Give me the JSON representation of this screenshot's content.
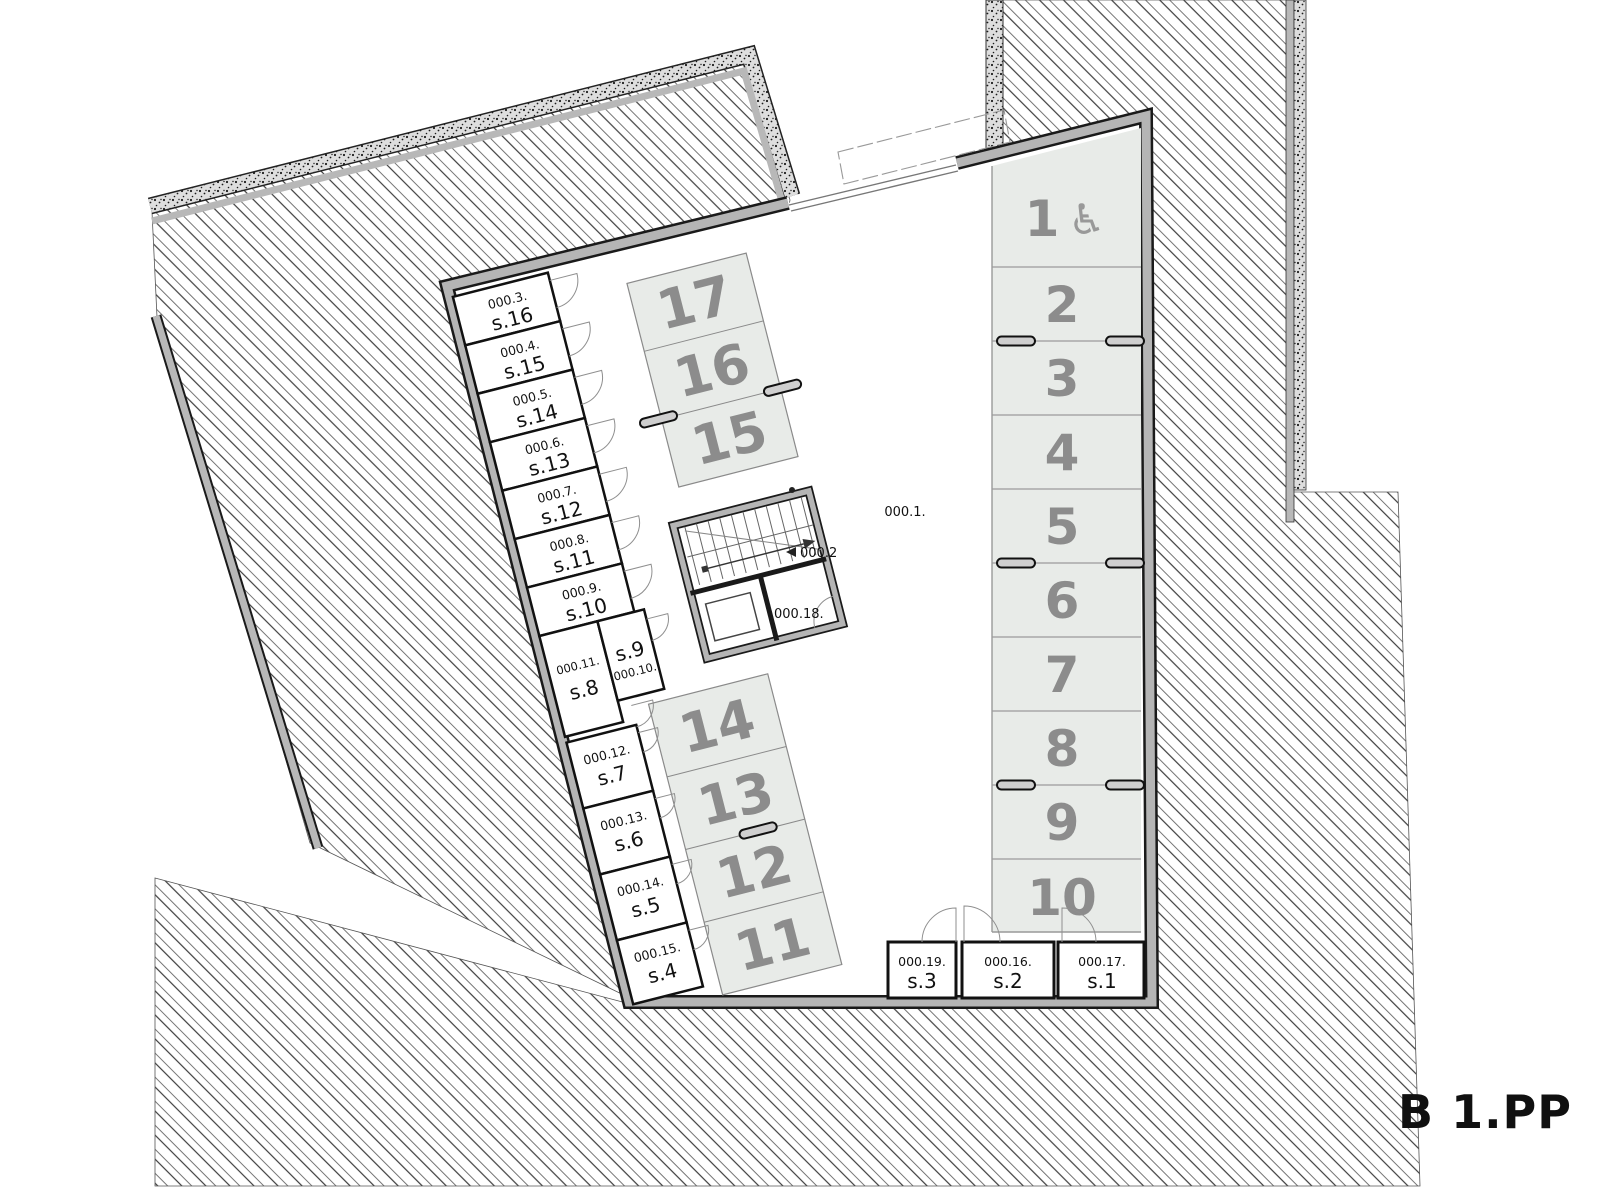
{
  "plan": {
    "title": "B 1.PP"
  },
  "areas": {
    "garage_code": "000.1.",
    "stairs_code": "000.2",
    "utility_code": "000.18."
  },
  "storage_rooms": [
    {
      "code": "000.3.",
      "name": "s.16"
    },
    {
      "code": "000.4.",
      "name": "s.15"
    },
    {
      "code": "000.5.",
      "name": "s.14"
    },
    {
      "code": "000.6.",
      "name": "s.13"
    },
    {
      "code": "000.7.",
      "name": "s.12"
    },
    {
      "code": "000.8.",
      "name": "s.11"
    },
    {
      "code": "000.9.",
      "name": "s.10"
    },
    {
      "code": "000.10.",
      "name": "s.9"
    },
    {
      "code": "000.11.",
      "name": "s.8"
    },
    {
      "code": "000.12.",
      "name": "s.7"
    },
    {
      "code": "000.13.",
      "name": "s.6"
    },
    {
      "code": "000.14.",
      "name": "s.5"
    },
    {
      "code": "000.15.",
      "name": "s.4"
    },
    {
      "code": "000.19.",
      "name": "s.3"
    },
    {
      "code": "000.16.",
      "name": "s.2"
    },
    {
      "code": "000.17.",
      "name": "s.1"
    }
  ],
  "parking": {
    "wheelchair_icon": "♿",
    "spots": [
      {
        "number": "1",
        "accessible": true
      },
      {
        "number": "2"
      },
      {
        "number": "3"
      },
      {
        "number": "4"
      },
      {
        "number": "5"
      },
      {
        "number": "6"
      },
      {
        "number": "7"
      },
      {
        "number": "8"
      },
      {
        "number": "9"
      },
      {
        "number": "10"
      },
      {
        "number": "11"
      },
      {
        "number": "12"
      },
      {
        "number": "13"
      },
      {
        "number": "14"
      },
      {
        "number": "15"
      },
      {
        "number": "16"
      },
      {
        "number": "17"
      }
    ]
  },
  "colors": {
    "parking_fill": "#e8ebe8",
    "wall_gray": "#b5b5b5",
    "number_gray": "#8c8c8c",
    "line_dark": "#1a1a1a"
  }
}
